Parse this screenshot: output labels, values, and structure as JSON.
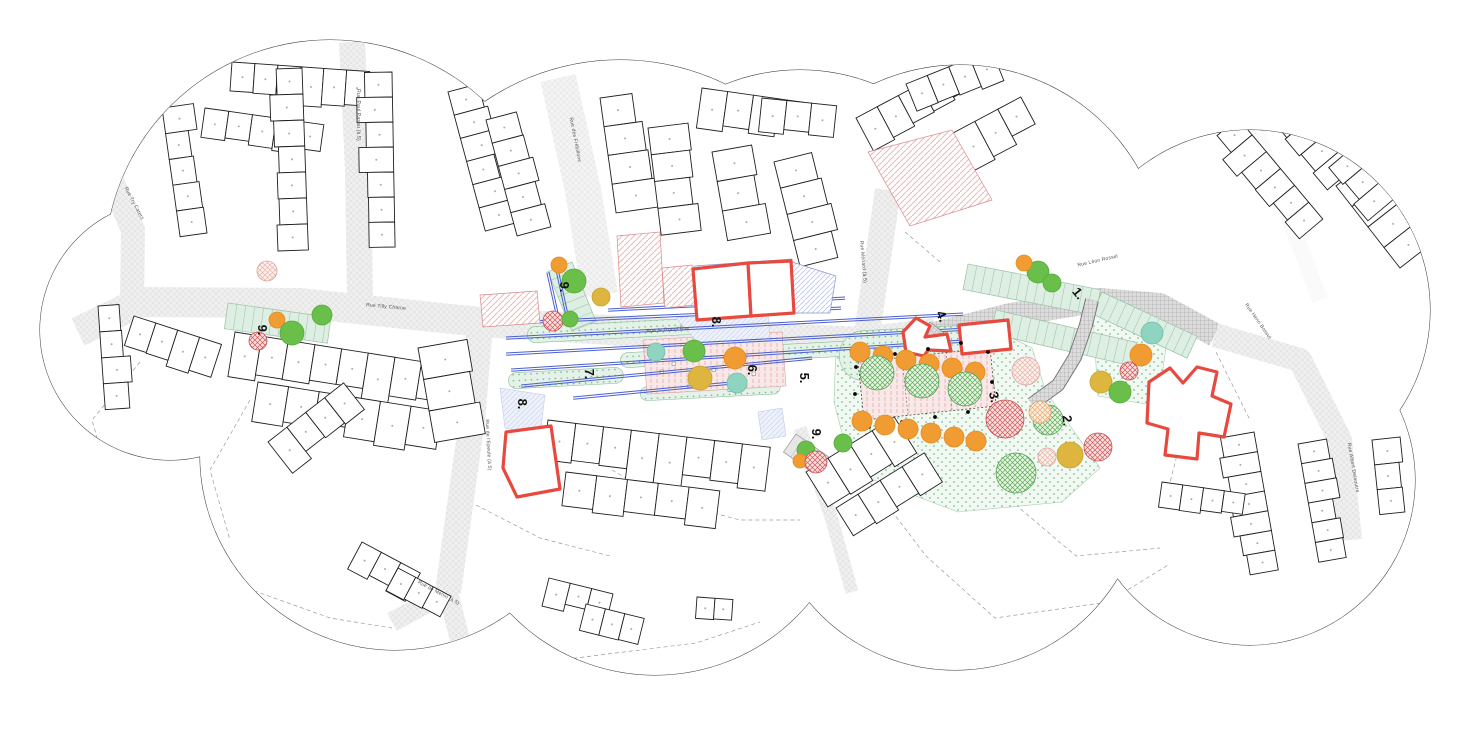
{
  "colors": {
    "cloud_outline": "#3a3a3a",
    "street_fill": "#efefef",
    "street_hatch": "#d8d8d8",
    "building_stroke": "#1f1f1f",
    "red_outline": "#e8493f",
    "red_hatch": "#f2b6b6",
    "blue_hatch": "#b9c4ec",
    "blue_line": "#4a5fd0",
    "tree_orange": "#f09c33",
    "tree_green": "#6abf4b",
    "tree_yellow": "#ddb53f",
    "tree_teal": "#8fd4c0",
    "lawn": "#f2f9f3",
    "plaza_pink": "#f9e8e8",
    "stall_green": "#ddeee2"
  },
  "cloud_circles": [
    [
      330,
      265,
      225
    ],
    [
      620,
      300,
      240
    ],
    [
      800,
      270,
      200
    ],
    [
      960,
      270,
      205
    ],
    [
      1250,
      310,
      180
    ],
    [
      1250,
      480,
      165
    ],
    [
      955,
      480,
      190
    ],
    [
      655,
      475,
      200
    ],
    [
      395,
      455,
      195
    ],
    [
      170,
      330,
      130
    ]
  ],
  "streets": [
    {
      "pts": "78,332 140,302 300,303 480,322 640,332 862,342 935,333",
      "w": 30,
      "pat": "hatchS"
    },
    {
      "pts": "930,335 1010,315 1100,300 1160,305 1215,335",
      "w": 24,
      "pat": "paver"
    },
    {
      "pts": "866,340 888,190",
      "w": 26,
      "pat": "hatchS"
    },
    {
      "pts": "352,42 358,170 360,298",
      "w": 26,
      "pat": "hatchS"
    },
    {
      "pts": "558,78 583,190 600,295",
      "w": 36,
      "pat": "hatchL"
    },
    {
      "pts": "480,325 472,420 458,520 448,592",
      "w": 26,
      "pat": "hatchS"
    },
    {
      "pts": "448,592 392,622",
      "w": 20,
      "pat": "hatchS"
    },
    {
      "pts": "448,592 462,648",
      "w": 20,
      "pat": "hatchS"
    },
    {
      "pts": "1215,335 1300,360 1340,440 1350,540",
      "w": 24,
      "pat": "hatchS"
    },
    {
      "pts": "103,160 133,230 132,300",
      "w": 24,
      "pat": "hatchS"
    },
    {
      "pts": "800,428 832,520 852,592",
      "w": 13,
      "pat": "hatchS"
    },
    {
      "pts": "1256,130 1320,300",
      "w": 16,
      "pat": "white"
    }
  ],
  "dashed_boundaries": [
    "140,362 92,420 118,512 210,575 330,618 392,628",
    "455,648 560,660 696,643 760,622",
    "862,472 926,556 995,618 1108,602 1168,565",
    "1140,362 1186,420 1166,498",
    "612,470 664,500 740,520 800,520",
    "250,400 210,470 230,540",
    "1010,500 1076,556 1160,548",
    "476,505 540,538 610,556",
    "905,232 940,262",
    "1216,352 1250,420"
  ],
  "building_clusters": [
    [
      232,
      62,
      4,
      6,
      23,
      36
    ],
    [
      205,
      108,
      8,
      5,
      24,
      30
    ],
    [
      302,
      68,
      88,
      7,
      26,
      30
    ],
    [
      392,
      72,
      89,
      7,
      25,
      30
    ],
    [
      448,
      92,
      75,
      6,
      24,
      -34
    ],
    [
      486,
      120,
      75,
      5,
      24,
      -30
    ],
    [
      162,
      108,
      82,
      5,
      26,
      -28
    ],
    [
      98,
      306,
      86,
      4,
      26,
      -26
    ],
    [
      134,
      316,
      18,
      4,
      23,
      32
    ],
    [
      235,
      332,
      9,
      8,
      27,
      42
    ],
    [
      258,
      382,
      9,
      6,
      31,
      38
    ],
    [
      418,
      348,
      80,
      3,
      32,
      -44
    ],
    [
      600,
      98,
      82,
      4,
      29,
      -38
    ],
    [
      648,
      128,
      83,
      4,
      27,
      -34
    ],
    [
      702,
      88,
      8,
      4,
      26,
      34
    ],
    [
      712,
      152,
      80,
      3,
      30,
      -40
    ],
    [
      774,
      162,
      76,
      4,
      27,
      -38
    ],
    [
      762,
      98,
      6,
      3,
      25,
      30
    ],
    [
      856,
      118,
      -28,
      5,
      24,
      34
    ],
    [
      906,
      158,
      -28,
      5,
      26,
      38
    ],
    [
      906,
      84,
      -22,
      4,
      23,
      28
    ],
    [
      1272,
      64,
      50,
      6,
      22,
      34
    ],
    [
      1238,
      118,
      50,
      6,
      22,
      32
    ],
    [
      1336,
      186,
      52,
      4,
      26,
      -38
    ],
    [
      1254,
      432,
      80,
      7,
      20,
      32
    ],
    [
      1298,
      444,
      80,
      6,
      20,
      -28
    ],
    [
      1372,
      440,
      84,
      3,
      25,
      -28
    ],
    [
      1162,
      482,
      8,
      4,
      21,
      26
    ],
    [
      548,
      420,
      7,
      8,
      28,
      46
    ],
    [
      566,
      472,
      7,
      5,
      31,
      34
    ],
    [
      806,
      472,
      -32,
      4,
      26,
      38
    ],
    [
      836,
      508,
      -32,
      4,
      26,
      34
    ],
    [
      549,
      578,
      14,
      3,
      22,
      26
    ],
    [
      586,
      604,
      14,
      3,
      20,
      24
    ],
    [
      697,
      597,
      4,
      2,
      18,
      22
    ],
    [
      268,
      442,
      -38,
      4,
      24,
      34
    ],
    [
      362,
      542,
      28,
      3,
      22,
      27
    ],
    [
      398,
      568,
      28,
      3,
      20,
      25
    ],
    [
      1352,
      148,
      50,
      3,
      22,
      30
    ]
  ],
  "hatched_parcels": [
    {
      "pts": "480,295 537,291 540,323 483,327",
      "pat": "hatchR"
    },
    {
      "pts": "617,236 660,232 664,303 621,307",
      "pat": "hatchR"
    },
    {
      "pts": "662,268 692,265 695,305 665,308",
      "pat": "hatchR"
    },
    {
      "pts": "868,152 952,130 992,200 910,226",
      "pat": "hatchR"
    },
    {
      "pts": "694,266 792,259 796,313 698,318",
      "pat": "hatchB"
    },
    {
      "pts": "792,262 836,276 830,313 795,313",
      "pat": "hatchB"
    }
  ],
  "wedges": [
    "676,318 768,308 770,340 700,345",
    "500,388 545,395 540,435 505,428",
    "758,412 782,408 786,436 762,440"
  ],
  "lawns": [
    "836,346 1000,332 1032,348 1046,392 1100,468 1062,502 958,512 852,472 834,402",
    "1092,302 1168,332 1158,406 1098,396"
  ],
  "planting_strips": [
    [
      527,
      327,
      175,
      16
    ],
    [
      620,
      353,
      240,
      15
    ],
    [
      838,
      332,
      150,
      50
    ],
    [
      508,
      373,
      115,
      16
    ],
    [
      640,
      387,
      140,
      14
    ]
  ],
  "stall_bands": [
    {
      "x": 968,
      "y": 264,
      "len": 135,
      "w": 26,
      "a": 11,
      "gray": false
    },
    {
      "x": 1102,
      "y": 292,
      "len": 105,
      "w": 24,
      "a": 25,
      "gray": false
    },
    {
      "x": 996,
      "y": 310,
      "len": 145,
      "w": 24,
      "a": 13,
      "gray": false
    },
    {
      "x": 228,
      "y": 303,
      "len": 104,
      "w": 26,
      "a": 8,
      "gray": false
    },
    {
      "x": 572,
      "y": 262,
      "len": 64,
      "w": 26,
      "a": 68,
      "gray": false
    },
    {
      "x": 796,
      "y": 434,
      "len": 58,
      "w": 22,
      "a": 35,
      "gray": true
    }
  ],
  "plazas": {
    "central": {
      "pts": "643,340 782,332 786,386 647,394"
    },
    "zone3": {
      "pts": "858,362 990,348 996,406 864,420",
      "dividers": [
        "902,357 908,415",
        "946,352 952,410"
      ]
    },
    "furniture_squares": [
      [
        672,
        362
      ],
      [
        712,
        368
      ],
      [
        752,
        372
      ],
      [
        688,
        384
      ],
      [
        728,
        388
      ],
      [
        660,
        370
      ]
    ]
  },
  "blue_lines": [
    [
      608,
      309,
      845,
      297
    ],
    [
      531,
      321,
      841,
      307
    ],
    [
      506,
      337,
      963,
      313
    ],
    [
      506,
      353,
      967,
      328
    ],
    [
      511,
      369,
      964,
      340
    ],
    [
      521,
      385,
      812,
      357
    ],
    [
      573,
      397,
      741,
      381
    ],
    [
      549,
      272,
      560,
      322
    ],
    [
      558,
      269,
      569,
      319
    ]
  ],
  "ladder_path": "1032,404 1058,385 1075,357 1086,325 1092,300",
  "mini_ladder": {
    "x": 930,
    "y": 322,
    "w": 24,
    "h": 13,
    "a": 38
  },
  "red_outline_buildings": [
    "693,269 748,263 751,316 697,320",
    "748,263 791,261 794,313 751,316",
    "506,432 551,426 560,489 517,497 503,468",
    "903,332 916,318 930,326 925,337 947,334 951,351 928,350 924,356 906,352",
    "959,325 1008,320 1011,349 962,354",
    "1149,382 1170,368 1183,383 1197,367 1217,372 1212,396 1231,404 1224,437 1199,433 1197,459 1165,455 1168,429 1147,423"
  ],
  "bollards": [
    [
      862,
      360
    ],
    [
      895,
      354
    ],
    [
      928,
      349
    ],
    [
      961,
      343
    ],
    [
      988,
      352
    ],
    [
      992,
      382
    ],
    [
      968,
      412
    ],
    [
      935,
      417
    ],
    [
      902,
      422
    ],
    [
      869,
      427
    ],
    [
      855,
      394
    ],
    [
      856,
      367
    ]
  ],
  "trees": [
    [
      "P",
      267,
      271,
      10
    ],
    [
      "o",
      277,
      320,
      8
    ],
    [
      "g",
      292,
      333,
      12
    ],
    [
      "g",
      322,
      315,
      10
    ],
    [
      "R",
      258,
      341,
      9
    ],
    [
      "o",
      559,
      265,
      8
    ],
    [
      "g",
      574,
      281,
      12
    ],
    [
      "y",
      601,
      297,
      9
    ],
    [
      "R",
      553,
      321,
      10
    ],
    [
      "g",
      570,
      319,
      8
    ],
    [
      "t",
      656,
      352,
      9
    ],
    [
      "g",
      694,
      351,
      11
    ],
    [
      "o",
      735,
      358,
      11
    ],
    [
      "y",
      700,
      378,
      12
    ],
    [
      "t",
      737,
      383,
      10
    ],
    [
      "o",
      860,
      352,
      10
    ],
    [
      "o",
      883,
      356,
      10
    ],
    [
      "o",
      906,
      360,
      10
    ],
    [
      "o",
      929,
      364,
      10
    ],
    [
      "o",
      952,
      368,
      10
    ],
    [
      "o",
      975,
      372,
      10
    ],
    [
      "o",
      862,
      421,
      10
    ],
    [
      "o",
      885,
      425,
      10
    ],
    [
      "o",
      908,
      429,
      10
    ],
    [
      "o",
      931,
      433,
      10
    ],
    [
      "o",
      954,
      437,
      10
    ],
    [
      "o",
      976,
      441,
      10
    ],
    [
      "G",
      877,
      373,
      17
    ],
    [
      "G",
      922,
      381,
      17
    ],
    [
      "G",
      965,
      389,
      17
    ],
    [
      "P",
      1026,
      371,
      14
    ],
    [
      "R",
      1005,
      419,
      19
    ],
    [
      "G",
      1048,
      420,
      15
    ],
    [
      "G",
      1016,
      473,
      20
    ],
    [
      "P",
      1047,
      457,
      9
    ],
    [
      "y",
      1070,
      455,
      13
    ],
    [
      "R",
      1098,
      447,
      14
    ],
    [
      "O",
      1040,
      412,
      11
    ],
    [
      "t",
      1152,
      333,
      11
    ],
    [
      "o",
      1141,
      355,
      11
    ],
    [
      "R",
      1129,
      371,
      9
    ],
    [
      "y",
      1101,
      382,
      11
    ],
    [
      "g",
      1120,
      392,
      11
    ],
    [
      "g",
      1038,
      272,
      11
    ],
    [
      "o",
      1024,
      263,
      8
    ],
    [
      "g",
      1052,
      283,
      9
    ],
    [
      "g",
      806,
      450,
      9
    ],
    [
      "g",
      843,
      443,
      9
    ],
    [
      "o",
      800,
      461,
      7
    ],
    [
      "R",
      816,
      462,
      11
    ]
  ],
  "zone_labels": [
    {
      "text": "9.",
      "x": 258,
      "y": 330,
      "rot": 90
    },
    {
      "text": "9.",
      "x": 560,
      "y": 287,
      "rot": 90
    },
    {
      "text": "9.",
      "x": 812,
      "y": 434,
      "rot": 90
    },
    {
      "text": "8.",
      "x": 712,
      "y": 322,
      "rot": 90
    },
    {
      "text": "8.",
      "x": 518,
      "y": 404,
      "rot": 90
    },
    {
      "text": "7.",
      "x": 585,
      "y": 374,
      "rot": 90
    },
    {
      "text": "6.",
      "x": 748,
      "y": 370,
      "rot": 90
    },
    {
      "text": "5.",
      "x": 800,
      "y": 378,
      "rot": 90
    },
    {
      "text": "4.",
      "x": 938,
      "y": 318,
      "rot": 65
    },
    {
      "text": "3.",
      "x": 990,
      "y": 398,
      "rot": 78
    },
    {
      "text": "2.",
      "x": 1063,
      "y": 421,
      "rot": 85
    },
    {
      "text": "1.",
      "x": 1075,
      "y": 296,
      "rot": 52
    }
  ],
  "street_labels": [
    {
      "text": "Rue Try Caters",
      "x": 133,
      "y": 204,
      "rot": 62
    },
    {
      "text": "Rue Paul Pasau (à 5)",
      "x": 357,
      "y": 115,
      "rot": 90
    },
    {
      "text": "Rue des Frébillons",
      "x": 574,
      "y": 140,
      "rot": 79
    },
    {
      "text": "Rue Tilly Charue",
      "x": 386,
      "y": 308,
      "rot": 5
    },
    {
      "text": "Rue le Grand'Rue",
      "x": 668,
      "y": 331,
      "rot": -4
    },
    {
      "text": "Rue Ménard (à 5)",
      "x": 862,
      "y": 262,
      "rot": 85
    },
    {
      "text": "Rue Léon Rossel",
      "x": 1098,
      "y": 262,
      "rot": -13
    },
    {
      "text": "Rue Henri Bossut",
      "x": 1257,
      "y": 322,
      "rot": 55
    },
    {
      "text": "Rue Albert Delaoutre",
      "x": 1352,
      "y": 468,
      "rot": 80
    },
    {
      "text": "Rue de l'Epeule (à 5)",
      "x": 487,
      "y": 445,
      "rot": 87
    },
    {
      "text": "Rue de Menin (à 5)",
      "x": 438,
      "y": 594,
      "rot": 28
    }
  ]
}
